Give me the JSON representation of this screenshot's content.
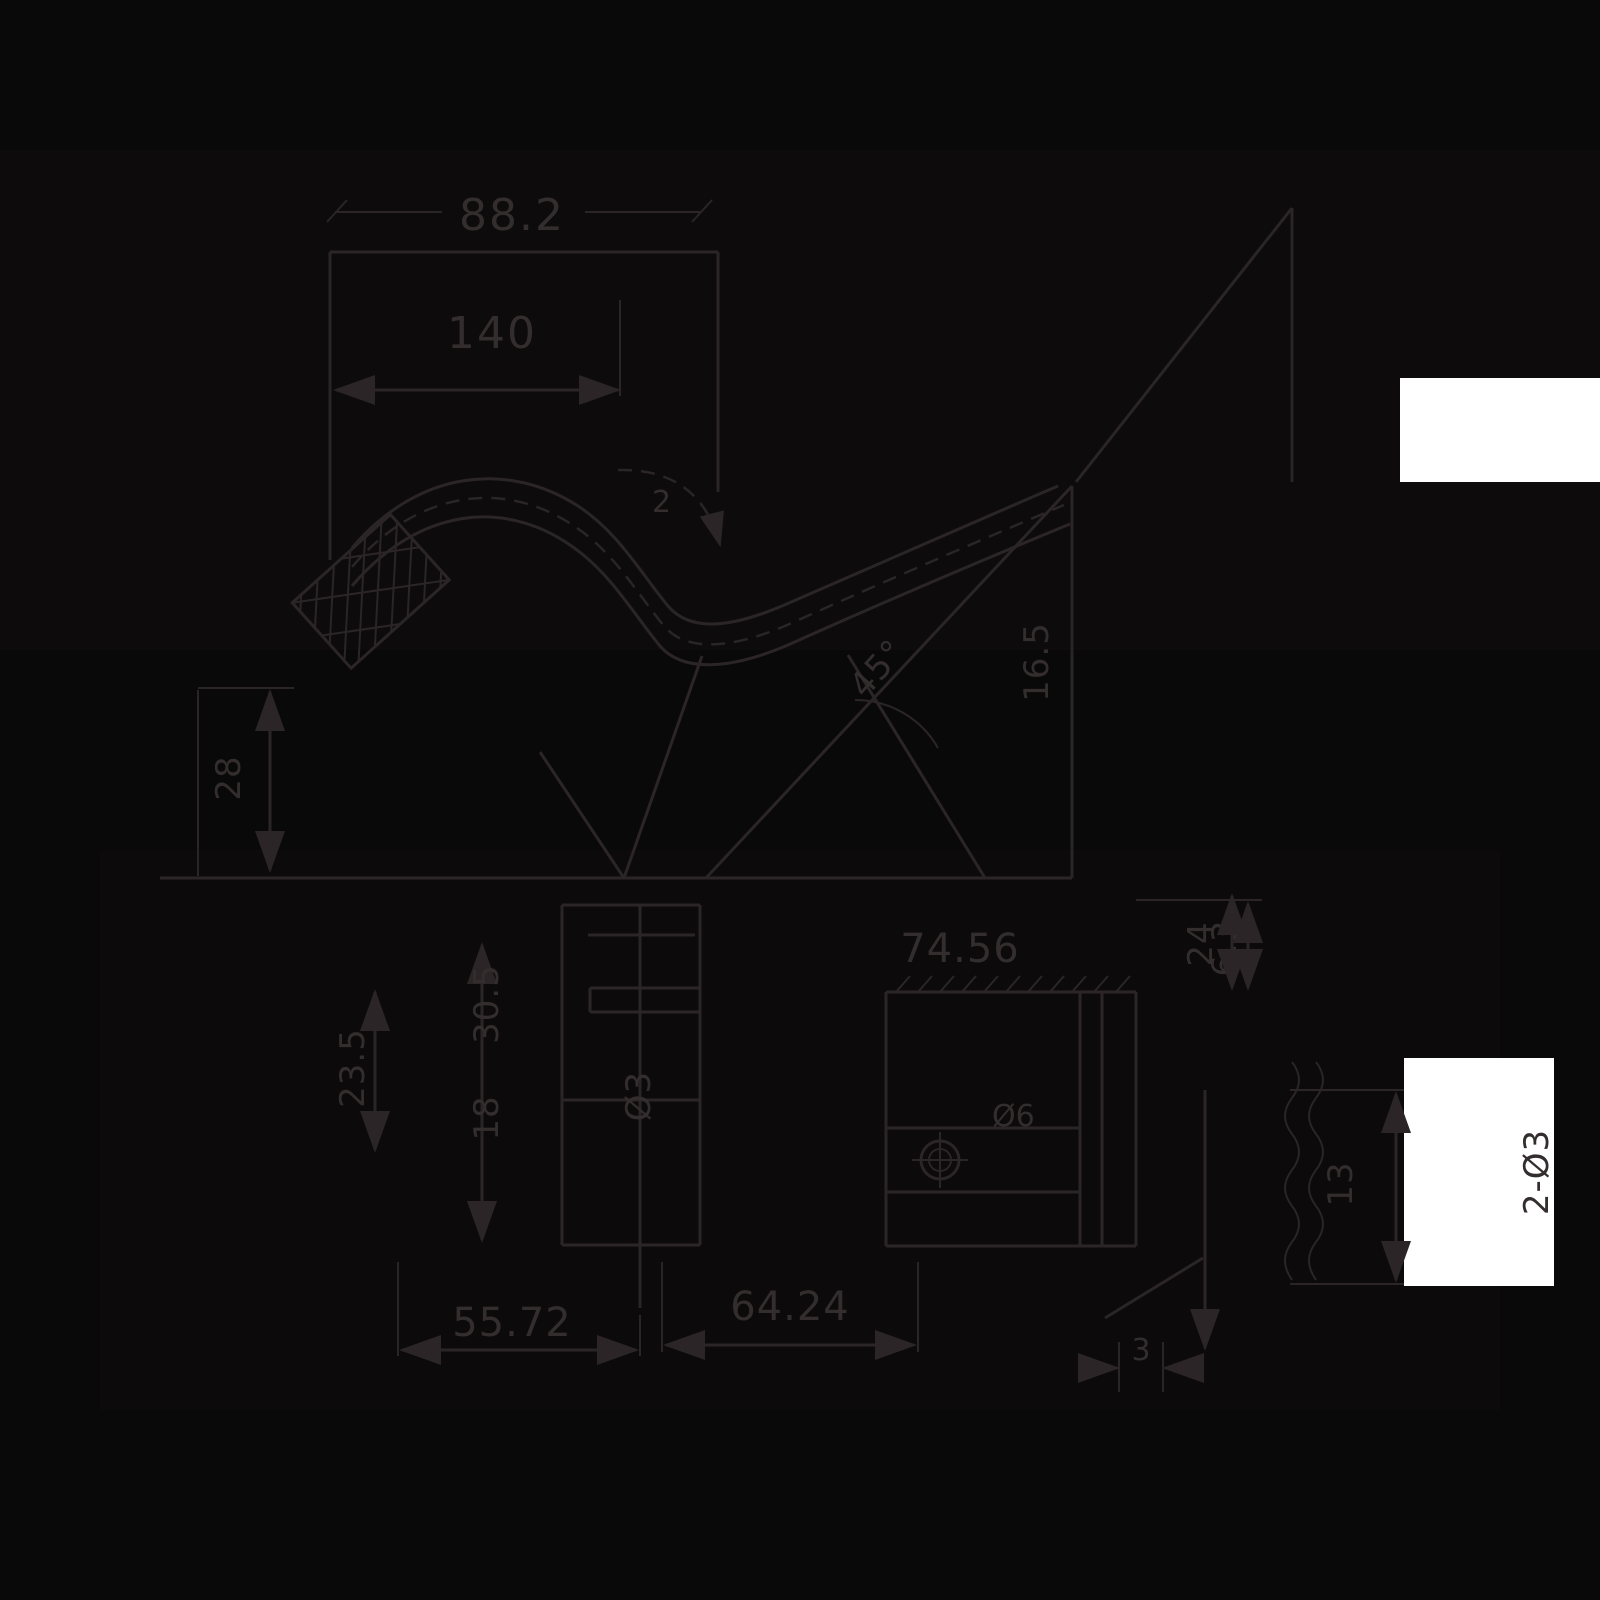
{
  "drawing": {
    "type": "mechanical-dimension-drawing",
    "background_color": "#0a0909",
    "stroke_color": "#2b2527",
    "text_color": "#332d2e",
    "patch_color": "#ffffff",
    "labels": [
      {
        "id": "dim-top-width",
        "text": "88.2"
      },
      {
        "id": "dim-upper-width",
        "text": "140"
      },
      {
        "id": "callout-bend",
        "text": "2"
      },
      {
        "id": "dim-left-height",
        "text": "28"
      },
      {
        "id": "dim-angle",
        "text": "45°"
      },
      {
        "id": "dim-slope-height",
        "text": "16.5"
      },
      {
        "id": "dim-right-height",
        "text": "24"
      },
      {
        "id": "dim-plate-width",
        "text": "74.56"
      },
      {
        "id": "dim-plate-edge",
        "text": "6.3"
      },
      {
        "id": "dim-step-a",
        "text": "30.5"
      },
      {
        "id": "dim-step-b",
        "text": "23.5"
      },
      {
        "id": "dim-step-c",
        "text": "18"
      },
      {
        "id": "dim-hole-small",
        "text": "Ø3"
      },
      {
        "id": "dim-hole-large",
        "text": "Ø6"
      },
      {
        "id": "dim-bottom-left",
        "text": "55.72"
      },
      {
        "id": "dim-bottom-mid",
        "text": "64.24"
      },
      {
        "id": "dim-slot",
        "text": "3"
      },
      {
        "id": "dim-break-height",
        "text": "13"
      },
      {
        "id": "dim-holes-pair",
        "text": "2-Ø3"
      }
    ]
  }
}
